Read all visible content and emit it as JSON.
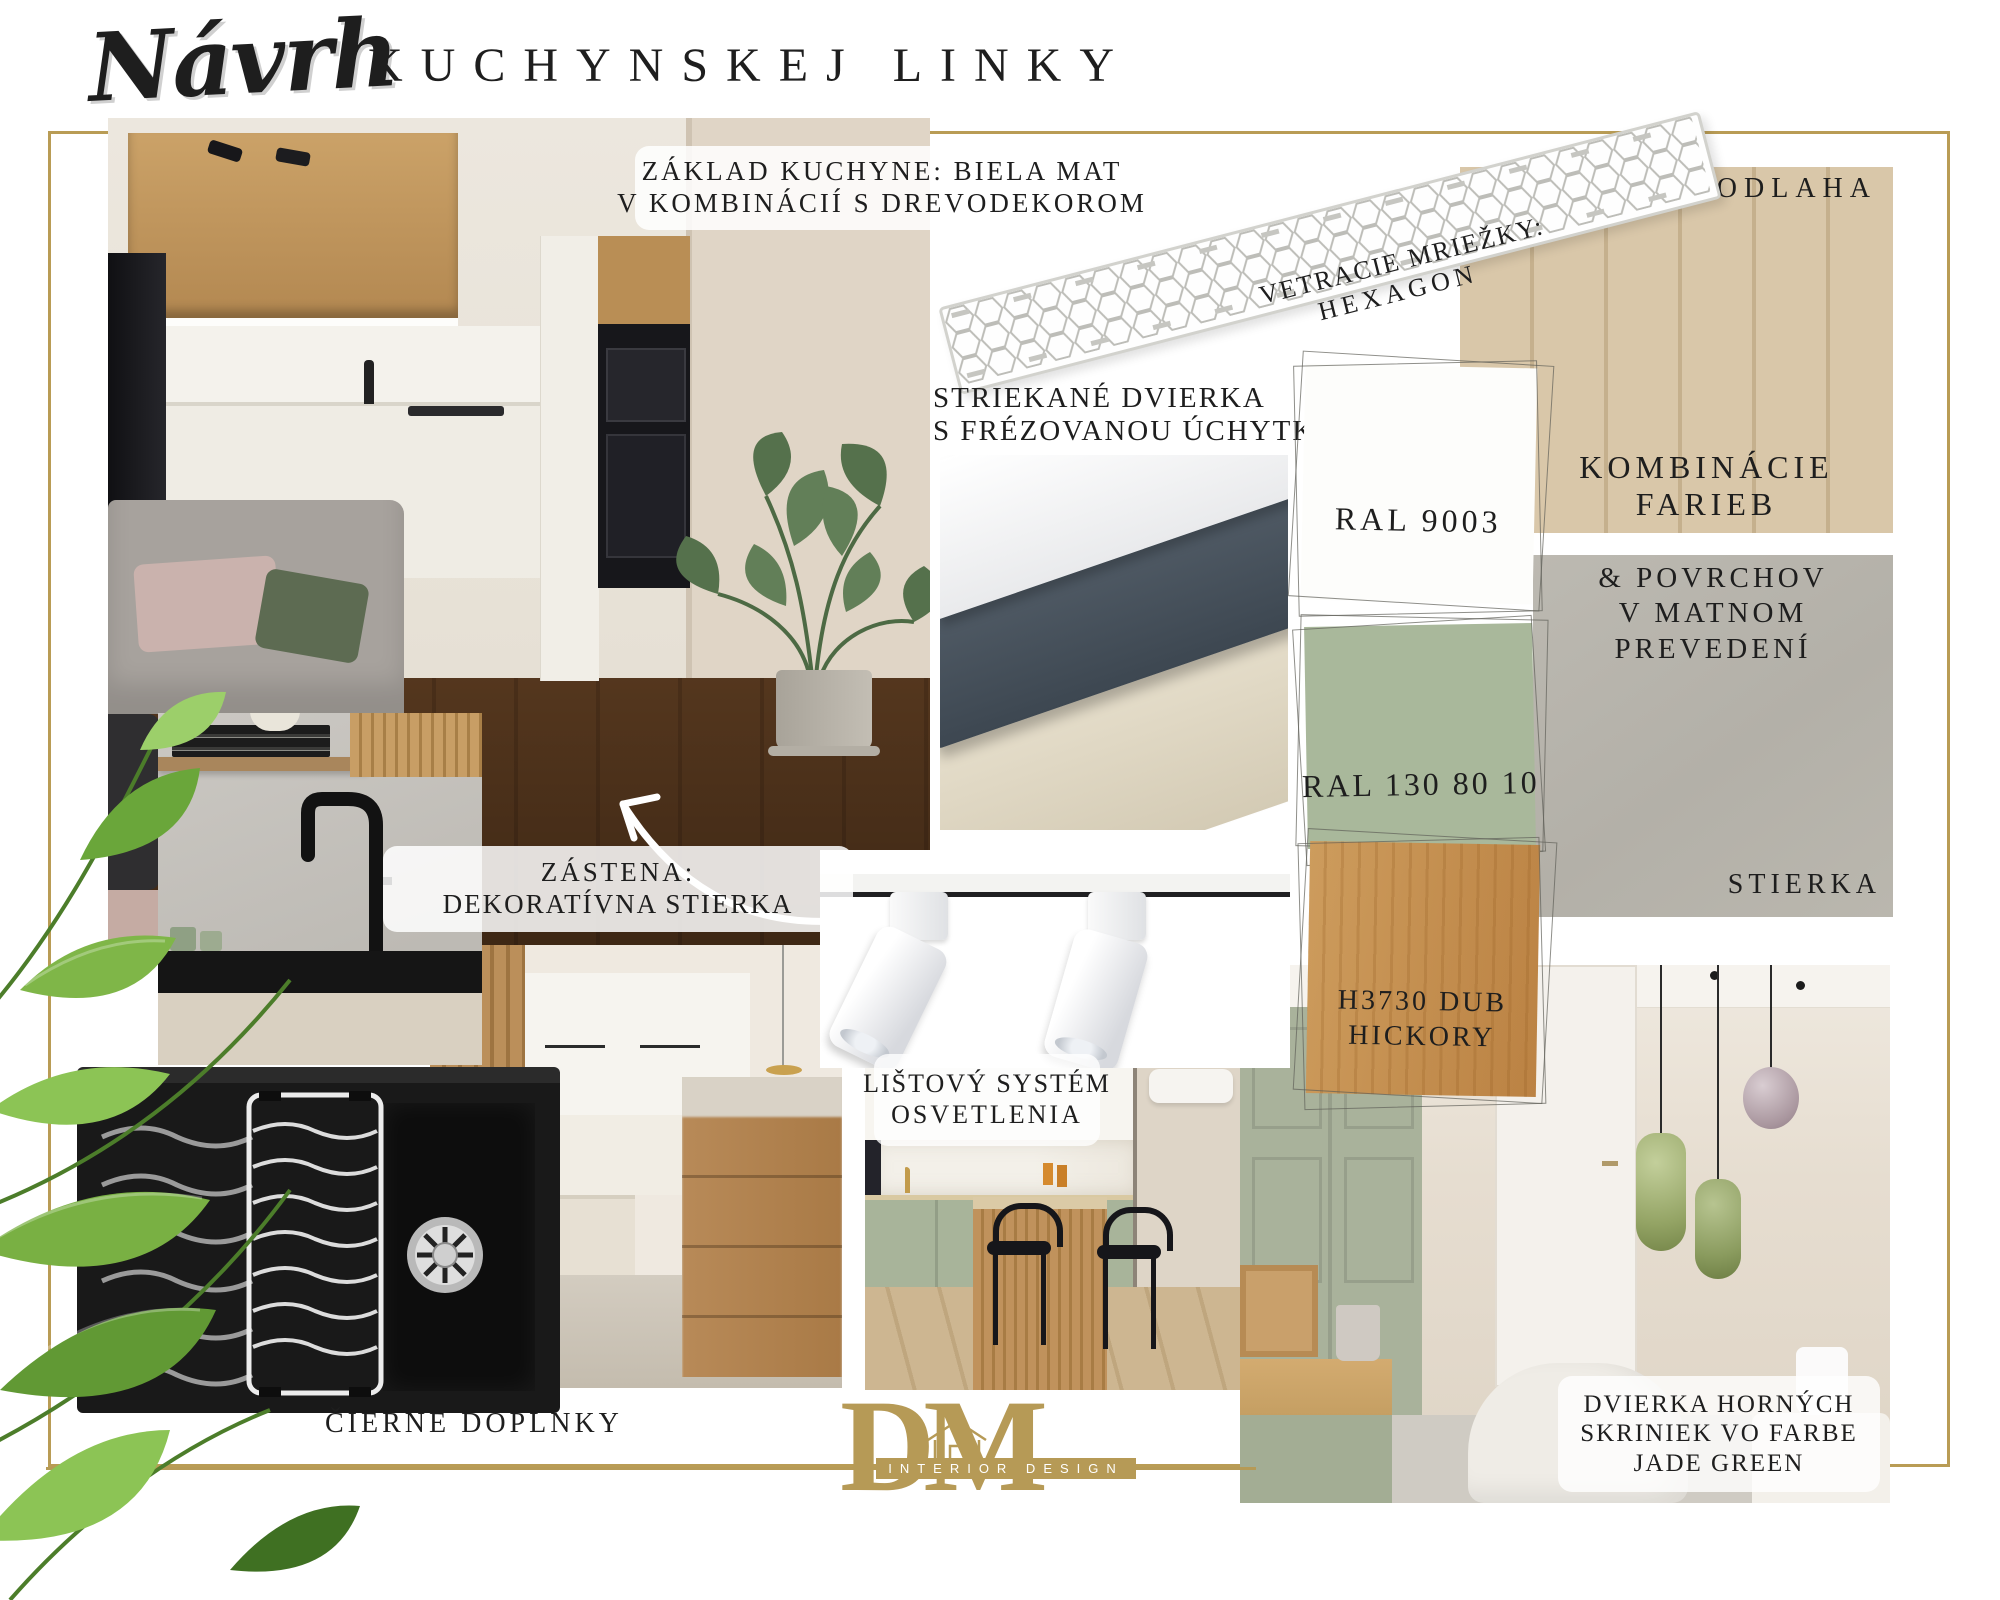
{
  "title": {
    "script": "Návrh",
    "main": "KUCHYNSKEJ LINKY"
  },
  "annotations": {
    "zaklad": {
      "line1": "ZÁKLAD KUCHYNE: BIELA MAT",
      "line2": "V KOMBINÁCIÍ S DREVODEKOROM"
    },
    "vetracie": {
      "line1": "VETRACIE MRIEŽKY:",
      "line2": "HEXAGON"
    },
    "podlaha": "PODLAHA",
    "striekane": {
      "line1": "STRIEKANÉ DVIERKA",
      "line2": "S FRÉZOVANOU ÚCHYTKOU"
    },
    "kombinacie": {
      "line1": "KOMBINÁCIE",
      "line2": "FARIEB"
    },
    "povrchy": {
      "line1": "& POVRCHOV",
      "line2": "V MATNOM",
      "line3": "PREVEDENÍ"
    },
    "stierka": "STIERKA",
    "zastena": {
      "line1": "ZÁSTENA:",
      "line2": "DEKORATÍVNA STIERKA"
    },
    "listovy": {
      "line1": "LIŠTOVÝ SYSTÉM",
      "line2": "OSVETLENIA"
    },
    "cierne": "ČIERNE DOPLNKY",
    "dvierka": {
      "line1": "DVIERKA HORNÝCH",
      "line2": "SKRINIEK VO FARBE",
      "line3": "JADE GREEN"
    }
  },
  "swatches": [
    {
      "code": "RAL 9003",
      "color": "#fdfdfb"
    },
    {
      "code": "RAL 130 80 10",
      "color": "#a9b89b"
    },
    {
      "code": "H3730 DUB",
      "code2": "HICKORY",
      "color": "#c3914f"
    }
  ],
  "logo": {
    "monogram": "DM",
    "subtitle": "INTERIOR DESIGN",
    "color": "#b69a56"
  },
  "colors": {
    "gold_frame": "#b99c55",
    "sage_green": "#a9b89b",
    "plaster_gray": "#b6b3aa",
    "anthracite_panel": "#46505c"
  }
}
